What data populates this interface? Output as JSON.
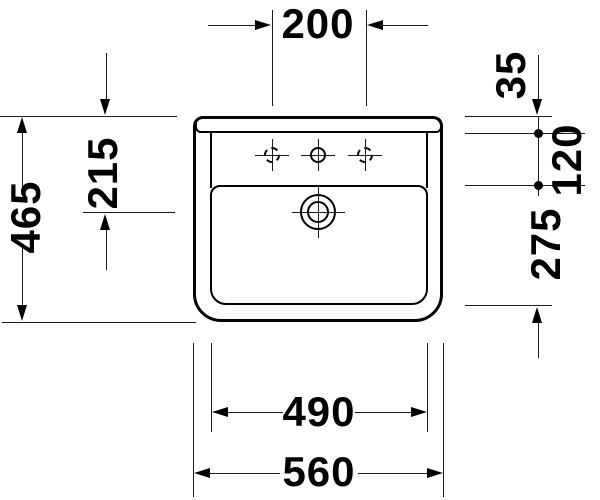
{
  "drawing": {
    "background": "#ffffff",
    "line_color": "#000000",
    "labels": {
      "tap_hole_spacing": "200",
      "overall_depth": "465",
      "drain_center_from_rear": "215",
      "rear_ledge_depth": "35",
      "tap_deck_depth": "120",
      "bowl_inner_depth": "275",
      "bowl_inner_width": "490",
      "overall_width": "560"
    }
  }
}
